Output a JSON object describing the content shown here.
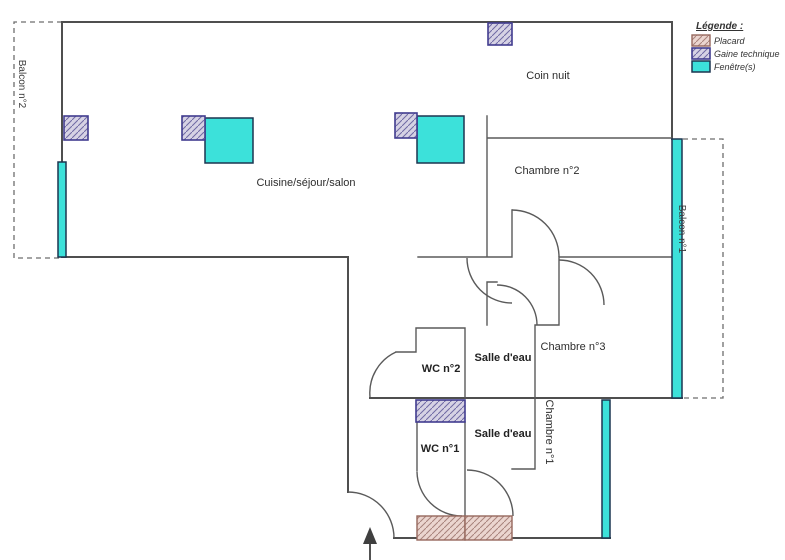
{
  "plan": {
    "type": "apartment-floor-plan",
    "labels": {
      "coin_nuit": "Coin nuit",
      "cuisine": "Cuisine/séjour/salon",
      "chambre2": "Chambre n°2",
      "chambre3": "Chambre n°3",
      "chambre1": "Chambre n°1",
      "wc2": "WC n°2",
      "wc1": "WC n°1",
      "salle_eau_haut": "Salle d'eau",
      "salle_eau_bas": "Salle d'eau",
      "balcon2": "Balcon n°2",
      "balcon1": "Balcon n°1"
    },
    "icons": {
      "entrance_arrow": "arrow-up"
    }
  },
  "legend": {
    "title": "Légende :",
    "items": [
      {
        "label": "Placard",
        "type": "placard"
      },
      {
        "label": "Gaine technique",
        "type": "gaine"
      },
      {
        "label": "Fenêtre(s)",
        "type": "fenetre"
      }
    ]
  },
  "colors": {
    "window": "#3ce1da",
    "window_border": "#1c3550",
    "gaine_fill": "#d6d2e4",
    "gaine_hatch": "#6f69a3",
    "gaine_border": "#413c8f",
    "placard_fill": "#ebd5cf",
    "placard_hatch": "#a8837b",
    "placard_border": "#96685d",
    "wall": "#4f4f4f",
    "dashed_boundary": "#6e6e6e",
    "text": "#2d2d2d"
  }
}
